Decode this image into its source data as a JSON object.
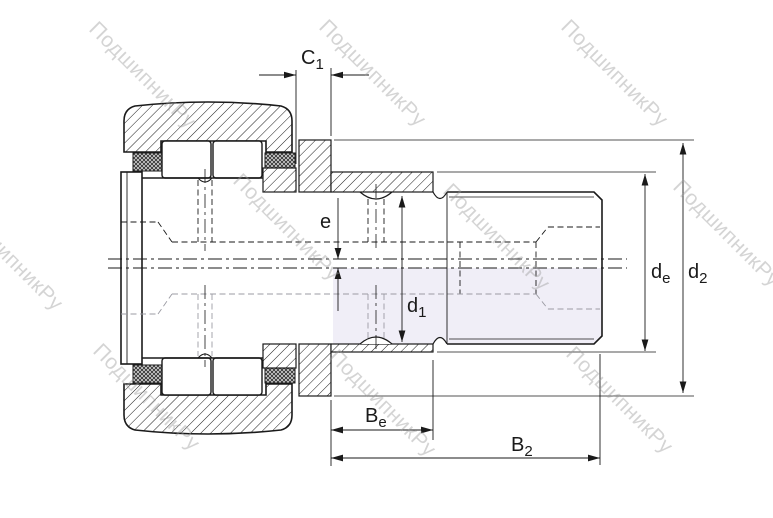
{
  "drawing": {
    "kind": "bearing-cross-section",
    "background": "#ffffff",
    "line_color": "#1a1a1a",
    "hidden_line_color": "#9b9ba3",
    "tint_color": "#f0eef7",
    "labels": {
      "C1": {
        "base": "C",
        "sub": "1"
      },
      "e": {
        "base": "e",
        "sub": ""
      },
      "d1": {
        "base": "d",
        "sub": "1"
      },
      "de": {
        "base": "d",
        "sub": "e"
      },
      "d2": {
        "base": "d",
        "sub": "2"
      },
      "Be": {
        "base": "B",
        "sub": "e"
      },
      "B2": {
        "base": "B",
        "sub": "2"
      }
    }
  },
  "watermark": {
    "text": "ПодшипникРу",
    "color": "#9a9a9a",
    "opacity": 0.42
  }
}
